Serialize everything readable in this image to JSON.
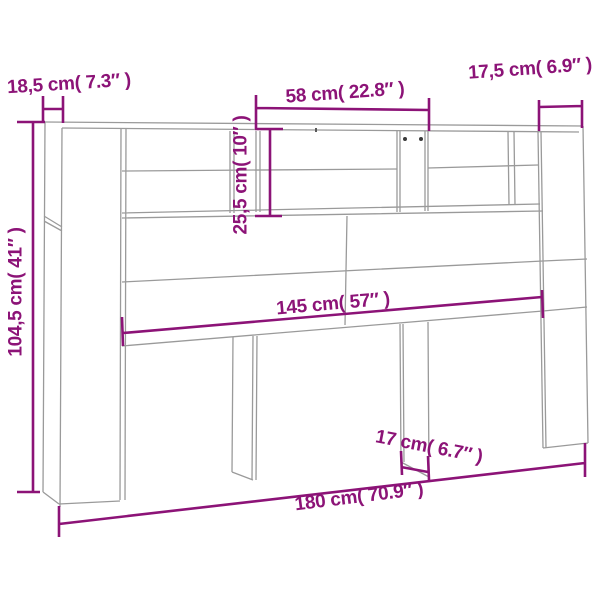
{
  "diagram": {
    "accent_color": "#8c1377",
    "line_color": "#9a9a9a",
    "background_color": "#ffffff",
    "dimensions": {
      "left_depth": {
        "cm": "18,5",
        "inches": "7.3",
        "label": "18,5 cm( 7.3″ )"
      },
      "top_shelf_width": {
        "cm": "58",
        "inches": "22.8",
        "label": "58 cm( 22.8″ )"
      },
      "right_depth": {
        "cm": "17,5",
        "inches": "6.9",
        "label": "17,5 cm( 6.9″ )"
      },
      "shelf_height": {
        "cm": "25,5",
        "inches": "10",
        "label": "25,5 cm( 10″ )"
      },
      "total_height": {
        "cm": "104,5",
        "inches": "41",
        "label": "104,5 cm( 41″ )"
      },
      "inner_width": {
        "cm": "145",
        "inches": "57",
        "label": "145 cm( 57″ )"
      },
      "support_width": {
        "cm": "17",
        "inches": "6.7",
        "label": "17 cm( 6.7″ )"
      },
      "total_width": {
        "cm": "180",
        "inches": "70.9",
        "label": "180 cm( 70.9″ )"
      }
    }
  }
}
